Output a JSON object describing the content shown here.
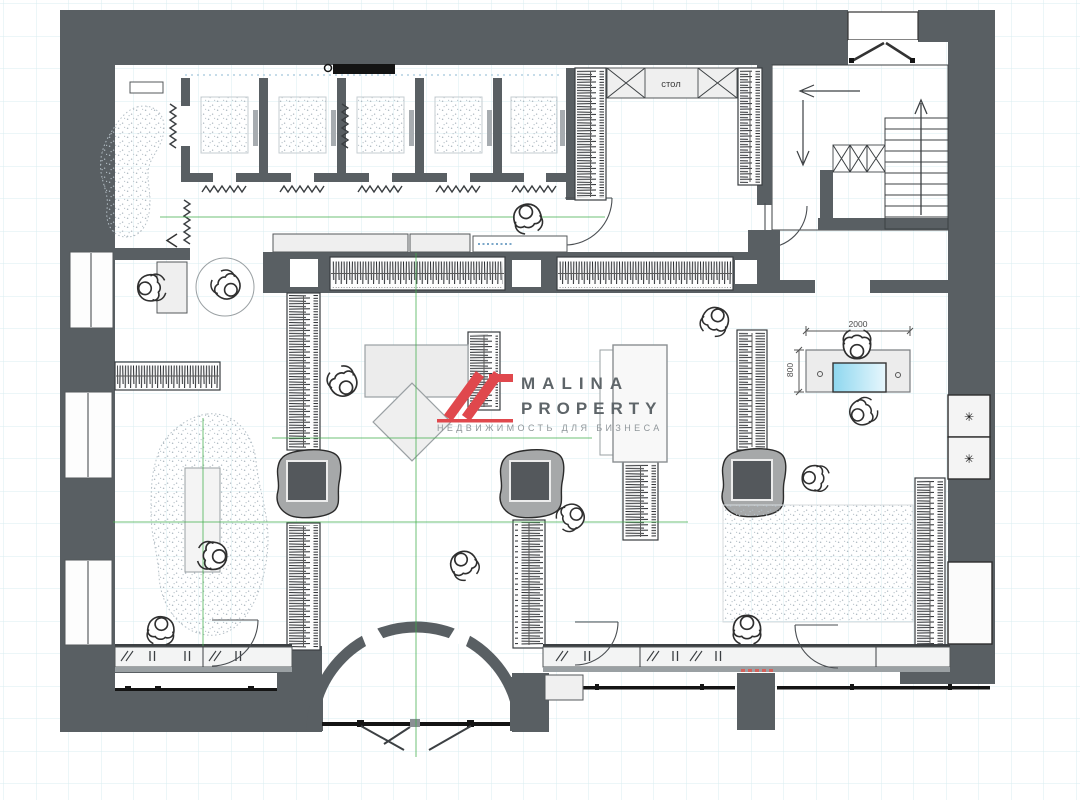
{
  "plan": {
    "labels": {
      "table_counter": "стол"
    },
    "dimensions": {
      "reception_desk_width": "2000",
      "reception_desk_depth": "800"
    },
    "symbols": {
      "appliance": "✳"
    },
    "watermark": {
      "line1": "MALINA",
      "line2": "PROPERTY",
      "tagline": "НЕДВИЖИМОСТЬ ДЛЯ БИЗНЕСА"
    },
    "colors": {
      "wall_gray": "#595f63",
      "grid_cyan": "#d9edf1",
      "axis_green": "#3fae4a",
      "brand_red": "#e0484d",
      "watermark_text": "#5e6569",
      "monitor_blue": "#9adcf2"
    }
  }
}
